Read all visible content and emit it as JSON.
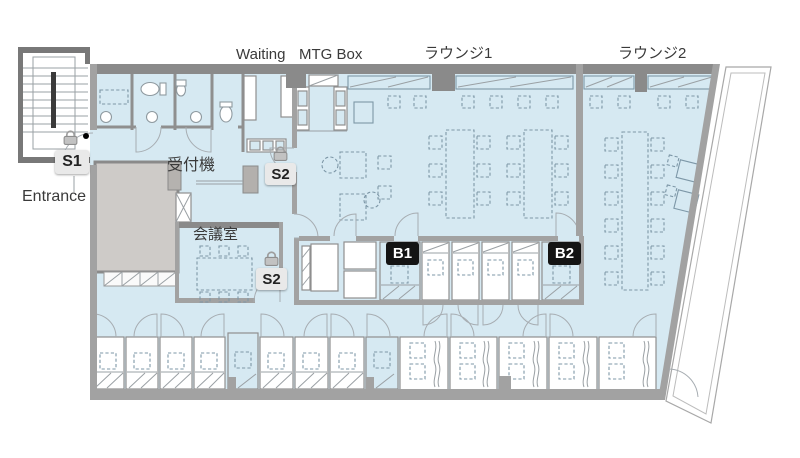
{
  "page": {
    "background": "#ffffff",
    "width": 800,
    "height": 458
  },
  "floorplan": {
    "area_labels": {
      "waiting": "Waiting",
      "mtg_box": "MTG Box",
      "lounge1": "ラウンジ1",
      "lounge2": "ラウンジ2",
      "reception_machine": "受付機",
      "meeting_room": "会議室",
      "entrance": "Entrance"
    },
    "markers": [
      {
        "id": "s1",
        "label": "S1",
        "type": "secure-door",
        "has_lock_icon": true
      },
      {
        "id": "s2-upper",
        "label": "S2",
        "type": "secure-door",
        "has_lock_icon": true
      },
      {
        "id": "s2-lower",
        "label": "S2",
        "type": "secure-door",
        "has_lock_icon": true
      },
      {
        "id": "b1",
        "label": "B1",
        "type": "booth",
        "has_lock_icon": false
      },
      {
        "id": "b2",
        "label": "B2",
        "type": "booth",
        "has_lock_icon": false
      }
    ],
    "colors": {
      "floor_highlight": "#d6e9f2",
      "wall": "#a2a2a2",
      "wall_dark": "#8a8a8a",
      "core_block": "#cecbc8",
      "furniture_line": "#7d97a7",
      "marker_light_bg": "#e9e9e9",
      "marker_light_text": "#222222",
      "marker_dark_bg": "#141414",
      "marker_dark_text": "#ffffff",
      "lock_icon": "#a6a6a6"
    }
  }
}
